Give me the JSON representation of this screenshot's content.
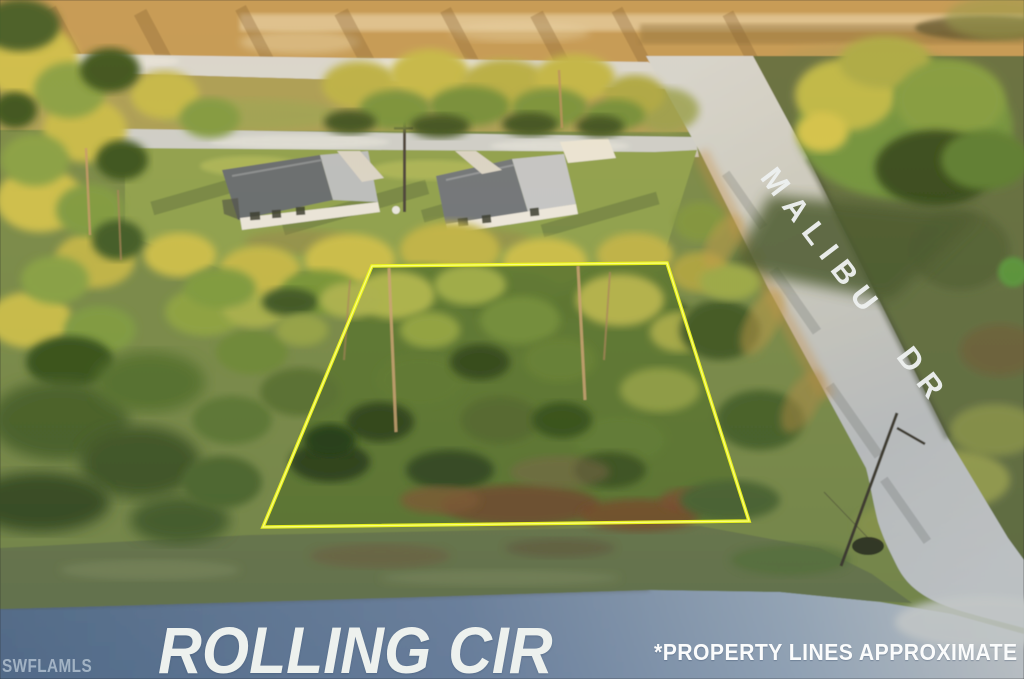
{
  "scene": {
    "street_label_bottom": "ROLLING CIR",
    "street_label_right": "MALIBU DR",
    "disclaimer": "*PROPERTY LINES APPROXIMATE",
    "watermark": "SWFLAMLS",
    "colors": {
      "property_outline": "#eef71a",
      "road_paint_text": "#eef1f0",
      "asphalt_bottom": "#5d7592",
      "concrete_side": "#c7cccd"
    }
  }
}
